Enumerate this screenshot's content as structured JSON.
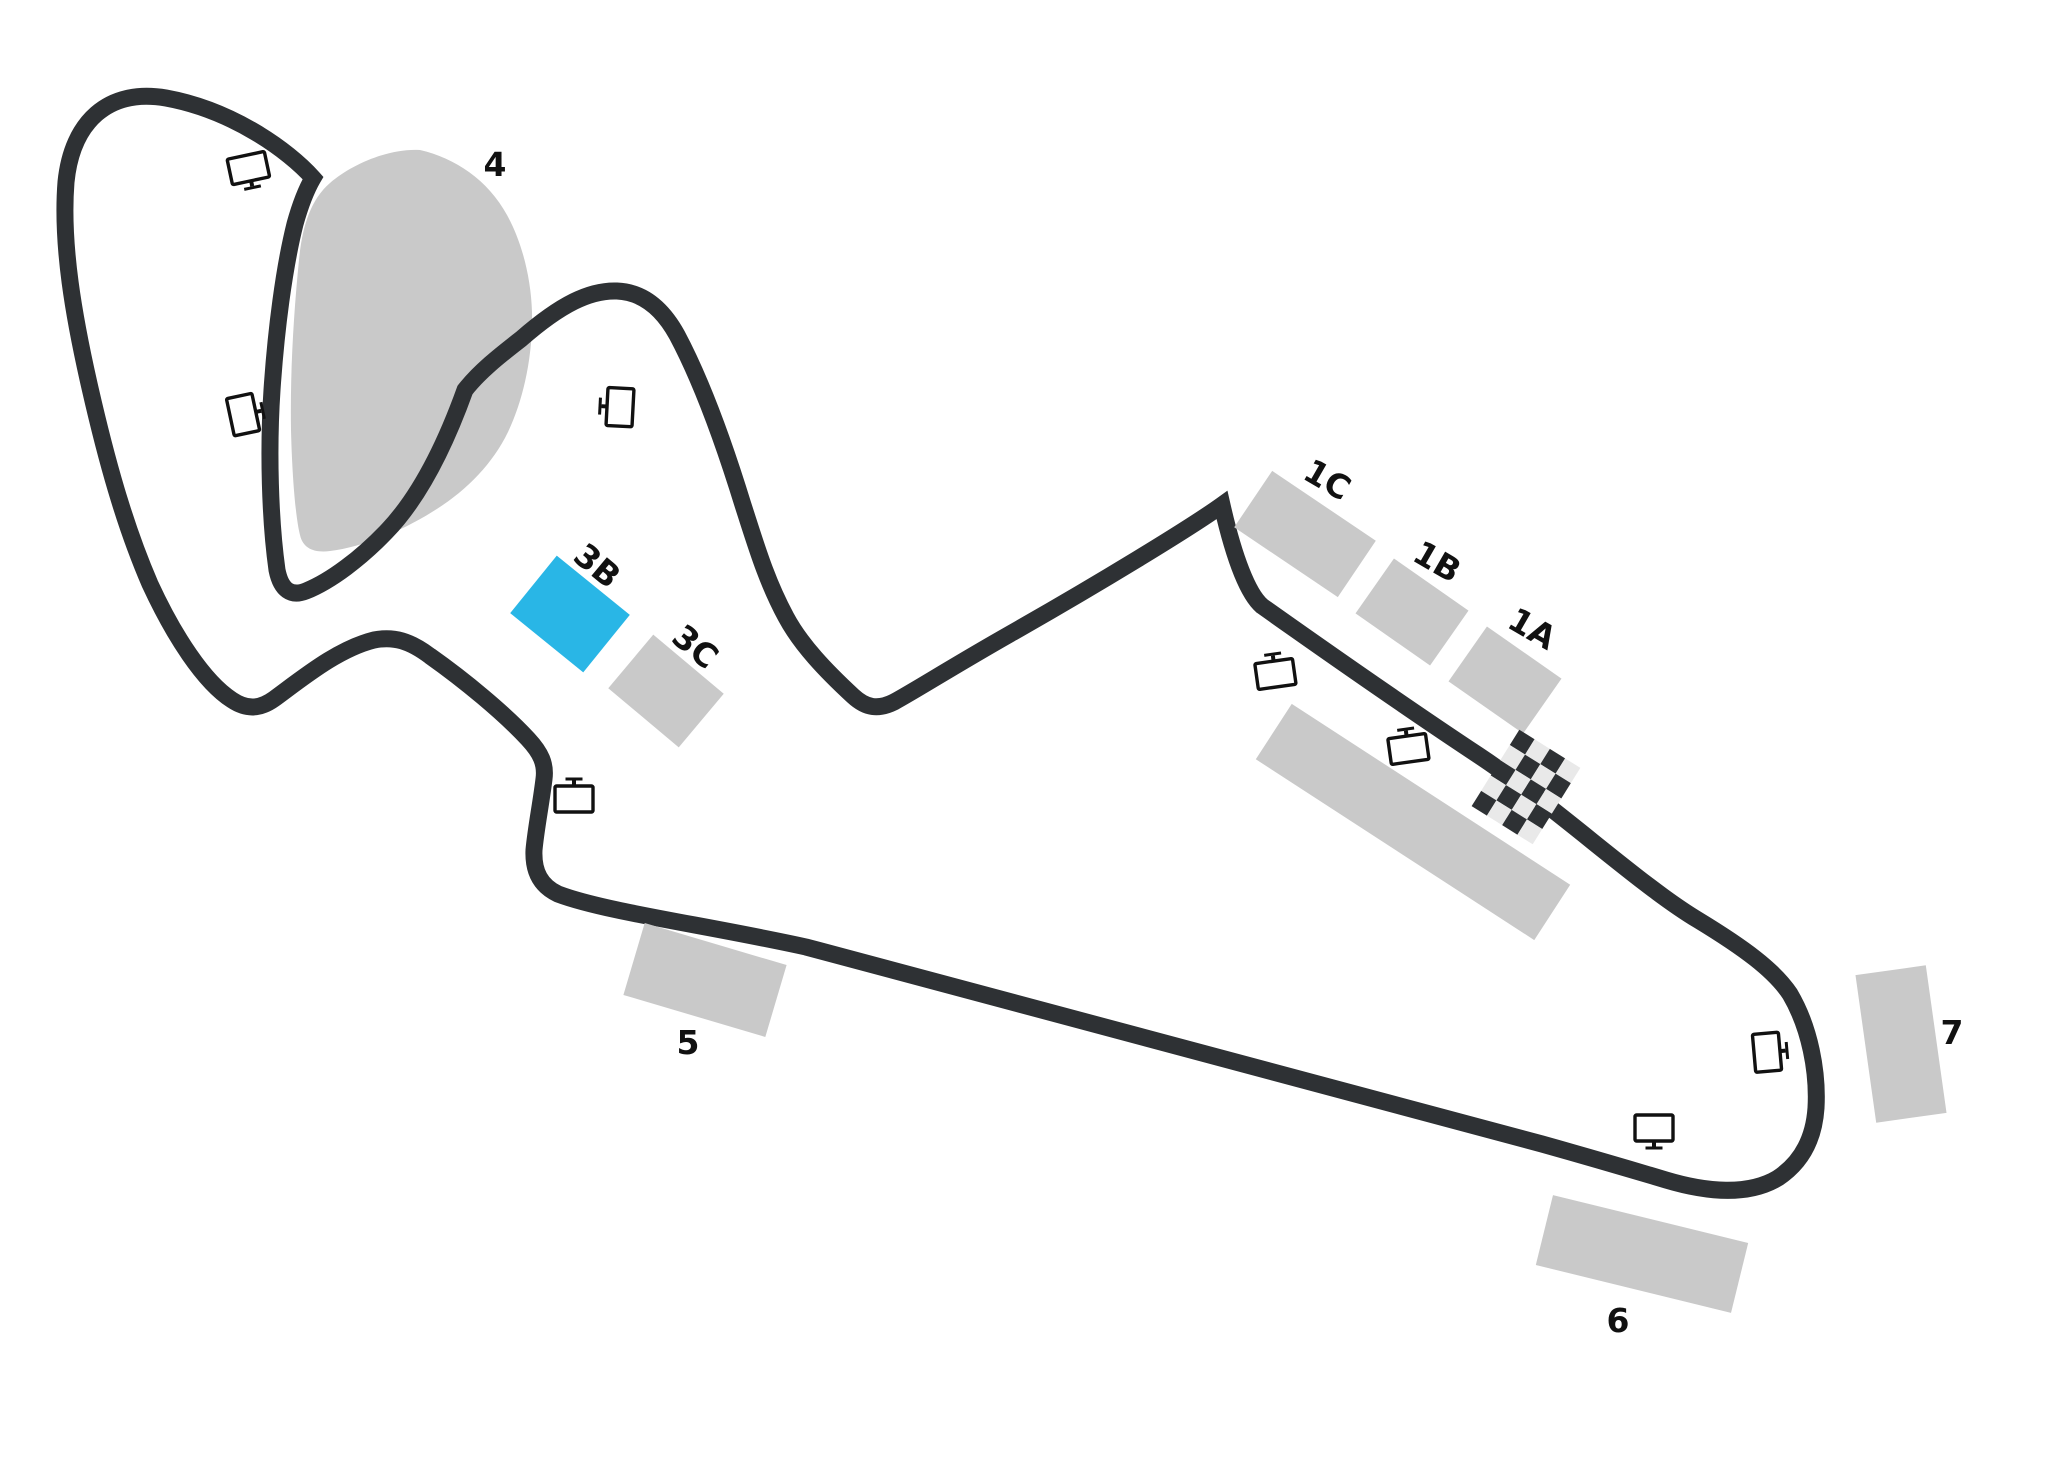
{
  "map": {
    "title": "race-circuit-seating-map",
    "colors": {
      "track": "#2e3134",
      "section": "#c9c9c9",
      "highlight": "#29b6e6",
      "label": "#111111",
      "background": "#ffffff",
      "checker_dark": "#2e3134",
      "checker_light": "#e9e9e9"
    },
    "sections": {
      "s1a": {
        "label": "1A",
        "highlighted": false
      },
      "s1b": {
        "label": "1B",
        "highlighted": false
      },
      "s1c": {
        "label": "1C",
        "highlighted": false
      },
      "s3b": {
        "label": "3B",
        "highlighted": true
      },
      "s3c": {
        "label": "3C",
        "highlighted": false
      },
      "s4": {
        "label": "4",
        "highlighted": false
      },
      "s5": {
        "label": "5",
        "highlighted": false
      },
      "s6": {
        "label": "6",
        "highlighted": false
      },
      "s7": {
        "label": "7",
        "highlighted": false
      },
      "main_grandstand": {
        "label": "",
        "highlighted": false
      }
    },
    "markers": {
      "screen_icon_count": 8,
      "screen_icon_meaning": "video-screen",
      "start_finish": "checkered-flag"
    }
  }
}
